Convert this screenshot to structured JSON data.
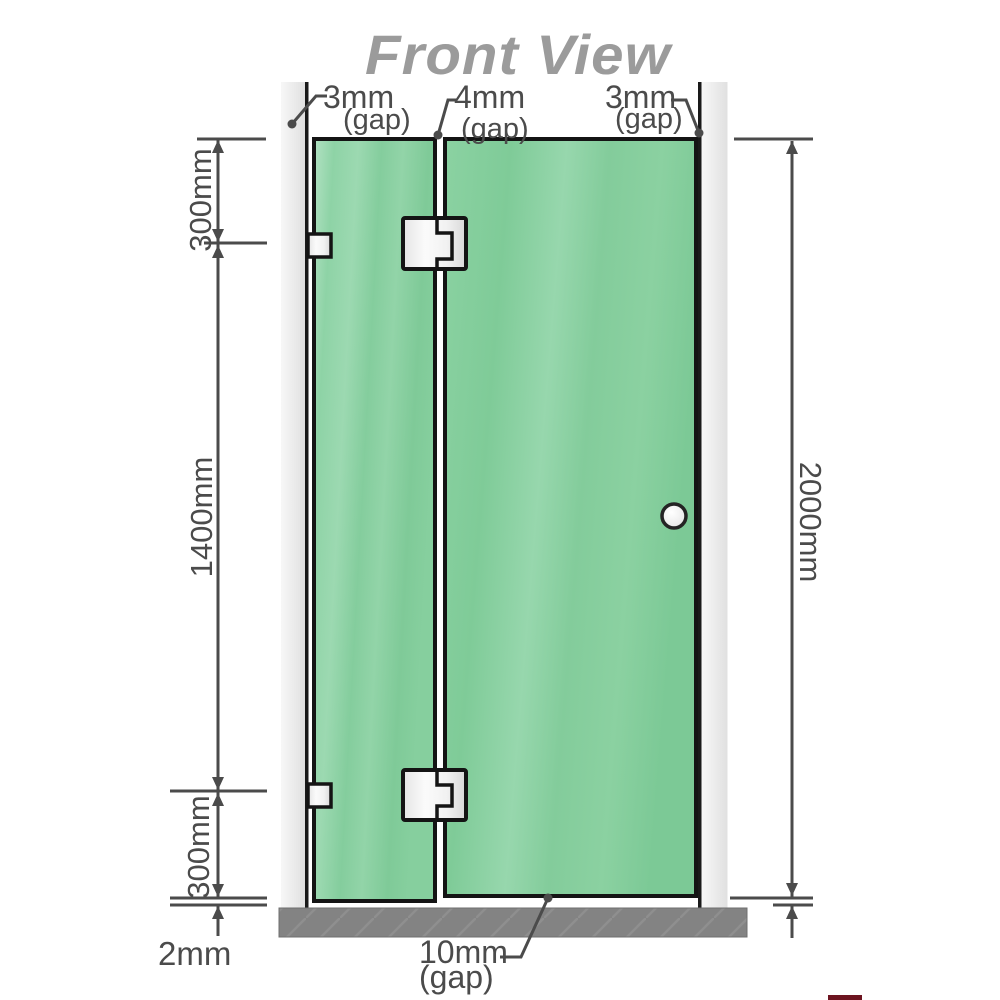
{
  "title": "Front View",
  "annotations": {
    "top_gap_left": {
      "value": "3mm",
      "qualifier": "(gap)"
    },
    "top_gap_middle": {
      "value": "4mm",
      "qualifier": "(gap)"
    },
    "top_gap_right": {
      "value": "3mm",
      "qualifier": "(gap)"
    },
    "left_dim_top": "300mm",
    "left_dim_middle": "1400mm",
    "left_dim_bottom": "300mm",
    "left_floor_gap": "2mm",
    "right_dim_total": "2000mm",
    "bottom_door_gap": {
      "value": "10mm",
      "qualifier": "(gap)"
    }
  },
  "colors": {
    "glass_green": "#84cb9c",
    "glass_highlight": "#a9e0bd",
    "wall_channel_gray": "#ebebeb",
    "floor_gray": "#838383",
    "dimension_line": "#4b4b4b",
    "title_gray": "#9b9b9b",
    "hardware_white": "#f5f5f5",
    "outline_black": "#161616"
  }
}
